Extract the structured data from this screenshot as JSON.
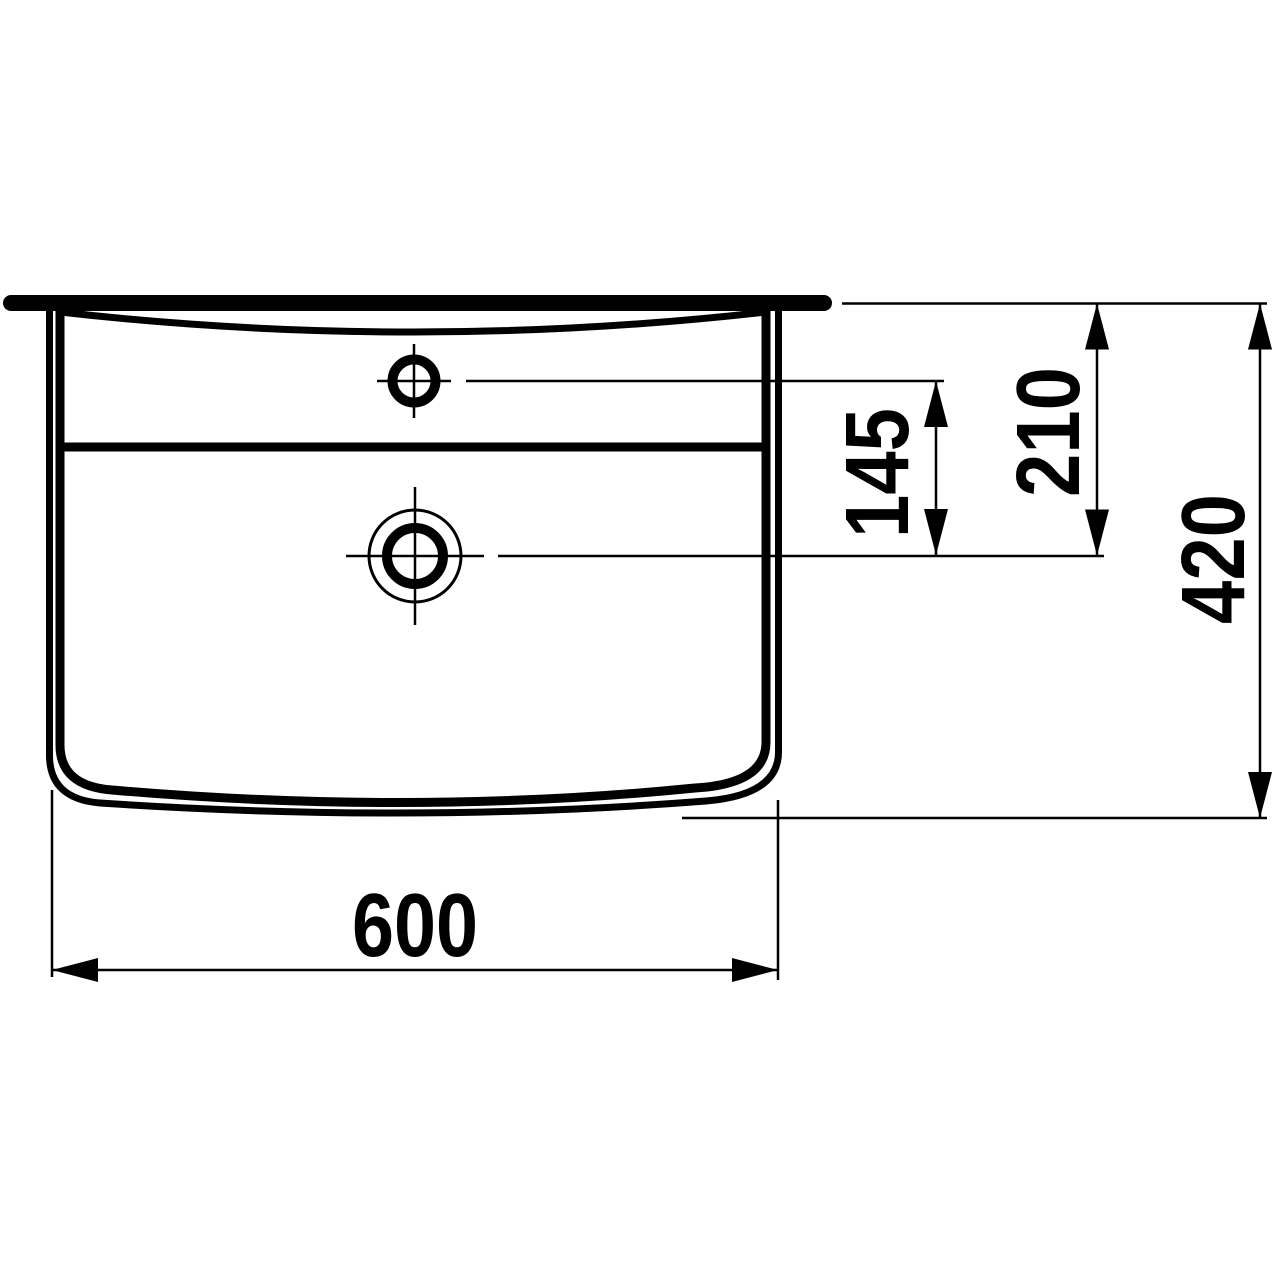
{
  "page": {
    "background": "#ffffff",
    "line_color": "#000000"
  },
  "diagram": {
    "type": "technical-dimension-drawing",
    "subject": "washbasin front elevation with tap hole and drain",
    "units": "mm",
    "labels": {
      "overall_width": "600",
      "overall_height": "420",
      "rim_to_drain": "210",
      "tap_hole_to_drain": "145"
    }
  }
}
